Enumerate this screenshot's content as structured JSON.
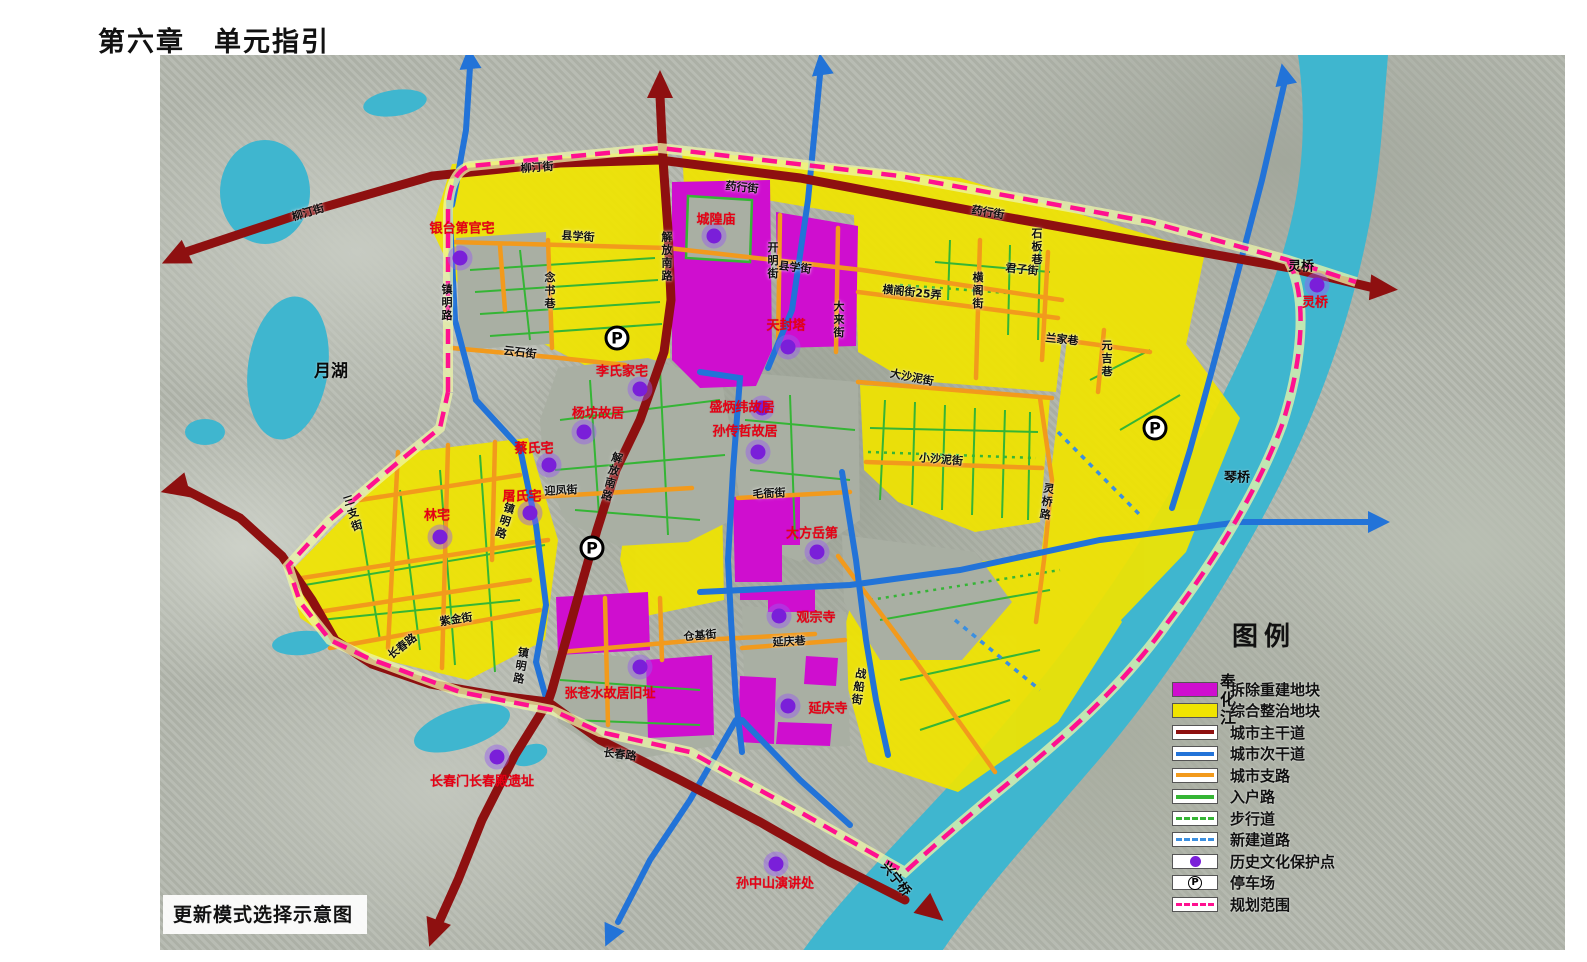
{
  "page": {
    "title": "第六章　单元指引",
    "caption": "更新模式选择示意图"
  },
  "legend": {
    "title": "图例",
    "items": [
      {
        "label": "拆除重建地块",
        "type": "fill",
        "color": "#cf0ecf"
      },
      {
        "label": "综合整治地块",
        "type": "fill",
        "color": "#f0e400"
      },
      {
        "label": "城市主干道",
        "type": "line",
        "color": "#8e1010"
      },
      {
        "label": "城市次干道",
        "type": "line",
        "color": "#2273d8"
      },
      {
        "label": "城市支路",
        "type": "line",
        "color": "#f29a1c"
      },
      {
        "label": "入户路",
        "type": "line",
        "color": "#35b535"
      },
      {
        "label": "步行道",
        "type": "dash",
        "color": "#35b535"
      },
      {
        "label": "新建道路",
        "type": "dash",
        "color": "#3b8fe0"
      },
      {
        "label": "历史文化保护点",
        "type": "dot",
        "color": "#7a1fd9"
      },
      {
        "label": "停车场",
        "type": "parking",
        "color": "#000000"
      },
      {
        "label": "规划范围",
        "type": "dash",
        "color": "#ff1090"
      }
    ]
  },
  "map": {
    "street_labels": [
      {
        "t": "柳汀街",
        "x": 308,
        "y": 212,
        "rot": -17
      },
      {
        "t": "柳汀街",
        "x": 537,
        "y": 167,
        "rot": -4
      },
      {
        "t": "药行街",
        "x": 742,
        "y": 187,
        "rot": 6
      },
      {
        "t": "药行街",
        "x": 988,
        "y": 212,
        "rot": 9
      },
      {
        "t": "县学街",
        "x": 578,
        "y": 236,
        "rot": 4
      },
      {
        "t": "县学街",
        "x": 795,
        "y": 267,
        "rot": 7
      },
      {
        "t": "念书巷",
        "x": 549,
        "y": 291,
        "v": 1
      },
      {
        "t": "云石街",
        "x": 520,
        "y": 352,
        "rot": 7
      },
      {
        "t": "镇明路",
        "x": 446,
        "y": 303,
        "v": 1
      },
      {
        "t": "镇明路",
        "x": 504,
        "y": 521,
        "v": 1,
        "rot": 18
      },
      {
        "t": "镇明路",
        "x": 520,
        "y": 666,
        "v": 1,
        "rot": 10
      },
      {
        "t": "解放南路",
        "x": 666,
        "y": 257,
        "v": 1
      },
      {
        "t": "解放南路",
        "x": 611,
        "y": 477,
        "v": 1,
        "rot": 15
      },
      {
        "t": "开明街",
        "x": 772,
        "y": 261,
        "v": 1
      },
      {
        "t": "大来街",
        "x": 838,
        "y": 320,
        "v": 1
      },
      {
        "t": "横阁街25弄",
        "x": 912,
        "y": 292,
        "rot": 6
      },
      {
        "t": "横阁街",
        "x": 977,
        "y": 291,
        "v": 1
      },
      {
        "t": "君子街",
        "x": 1022,
        "y": 269,
        "rot": 6
      },
      {
        "t": "石板巷",
        "x": 1036,
        "y": 247,
        "v": 1
      },
      {
        "t": "兰家巷",
        "x": 1062,
        "y": 339,
        "rot": 6
      },
      {
        "t": "元吉巷",
        "x": 1106,
        "y": 359,
        "v": 1
      },
      {
        "t": "大沙泥街",
        "x": 912,
        "y": 377,
        "rot": 11
      },
      {
        "t": "小沙泥街",
        "x": 941,
        "y": 459,
        "rot": 5
      },
      {
        "t": "灵桥路",
        "x": 1046,
        "y": 502,
        "v": 1,
        "rot": 8
      },
      {
        "t": "三支街",
        "x": 352,
        "y": 514,
        "v": 1,
        "rot": -18
      },
      {
        "t": "紫金街",
        "x": 456,
        "y": 619,
        "rot": -9
      },
      {
        "t": "长春路",
        "x": 402,
        "y": 646,
        "rot": -38
      },
      {
        "t": "长春路",
        "x": 620,
        "y": 754,
        "rot": 7
      },
      {
        "t": "仓基街",
        "x": 700,
        "y": 635,
        "rot": -5
      },
      {
        "t": "延庆巷",
        "x": 789,
        "y": 641,
        "rot": -3
      },
      {
        "t": "毛衙街",
        "x": 769,
        "y": 493,
        "rot": -3
      },
      {
        "t": "迎凤街",
        "x": 561,
        "y": 490,
        "rot": -3
      },
      {
        "t": "战船街",
        "x": 858,
        "y": 687,
        "v": 1,
        "rot": 8
      }
    ],
    "water_labels": [
      {
        "t": "月湖",
        "x": 331,
        "y": 369,
        "size": 17
      },
      {
        "t": "奉化江",
        "x": 1226,
        "y": 700,
        "v": 1,
        "size": 16
      },
      {
        "t": "琴桥",
        "x": 1237,
        "y": 476,
        "size": 13
      },
      {
        "t": "灵桥",
        "x": 1301,
        "y": 265,
        "size": 13
      },
      {
        "t": "兴宁桥",
        "x": 897,
        "y": 878,
        "rot": 52,
        "size": 13
      }
    ],
    "historic_sites": [
      {
        "name": "银台第官宅",
        "lx": 462,
        "ly": 227,
        "dx": 460,
        "dy": 258
      },
      {
        "name": "城隍庙",
        "lx": 716,
        "ly": 218,
        "dx": 714,
        "dy": 236
      },
      {
        "name": "天封塔",
        "lx": 786,
        "ly": 324,
        "dx": 788,
        "dy": 347
      },
      {
        "name": "李氏家宅",
        "lx": 622,
        "ly": 370,
        "dx": 640,
        "dy": 389
      },
      {
        "name": "杨坊故居",
        "lx": 598,
        "ly": 412,
        "dx": 584,
        "dy": 432
      },
      {
        "name": "盛炳纬故居",
        "lx": 742,
        "ly": 406,
        "dx": 762,
        "dy": 408
      },
      {
        "name": "孙传哲故居",
        "lx": 745,
        "ly": 430,
        "dx": 758,
        "dy": 452
      },
      {
        "name": "蔡氏宅",
        "lx": 534,
        "ly": 447,
        "dx": 549,
        "dy": 465
      },
      {
        "name": "屠氏宅",
        "lx": 522,
        "ly": 495,
        "dx": 530,
        "dy": 513
      },
      {
        "name": "林宅",
        "lx": 437,
        "ly": 514,
        "dx": 440,
        "dy": 537
      },
      {
        "name": "大方岳第",
        "lx": 812,
        "ly": 532,
        "dx": 817,
        "dy": 552
      },
      {
        "name": "观宗寺",
        "lx": 816,
        "ly": 616,
        "dx": 779,
        "dy": 616
      },
      {
        "name": "延庆寺",
        "lx": 828,
        "ly": 707,
        "dx": 788,
        "dy": 706
      },
      {
        "name": "张苍水故居旧址",
        "lx": 610,
        "ly": 692,
        "dx": 640,
        "dy": 667
      },
      {
        "name": "长春门长春殿遗址",
        "lx": 482,
        "ly": 780,
        "dx": 497,
        "dy": 757
      },
      {
        "name": "孙中山演讲处",
        "lx": 775,
        "ly": 882,
        "dx": 776,
        "dy": 864
      },
      {
        "name": "灵桥",
        "lx": 1315,
        "ly": 301,
        "dx": 1317,
        "dy": 285
      }
    ],
    "parking": [
      {
        "x": 617,
        "y": 338
      },
      {
        "x": 592,
        "y": 548
      },
      {
        "x": 1155,
        "y": 428
      }
    ]
  }
}
